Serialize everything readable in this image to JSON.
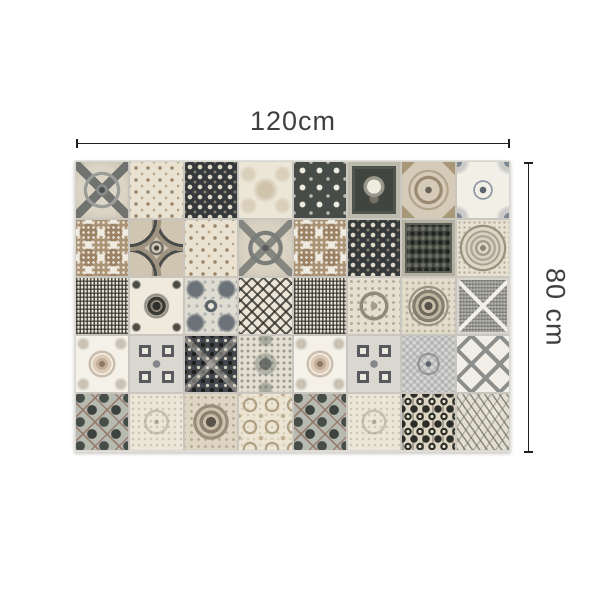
{
  "dimensions": {
    "width_label": "120cm",
    "height_label": "80 cm"
  },
  "mat": {
    "description": "patchwork azulejo-style vinyl tile mat, grayscale and taupe vintage patterns",
    "grid": {
      "rows": 5,
      "cols": 8
    },
    "tiles": [
      "gray-cross-medallion",
      "tan-floral-lattice",
      "dark-damask",
      "faded-damask",
      "charcoal-snowflake",
      "framed-bouquet",
      "taupe-octagon",
      "corner-flourish",
      "taupe-rosette-dots",
      "concave-frame",
      "tan-floral-lattice",
      "gray-circle-cross",
      "taupe-rosette-dots",
      "dark-damask",
      "dark-pictorial",
      "lace-mandala",
      "speckle-maze",
      "black-sunflower",
      "gray-kaleidoscope",
      "argyle-cross",
      "speckle-maze",
      "damask-wreath",
      "target-medallion",
      "diamond-x-speckle",
      "rose-swirl",
      "four-squares",
      "dark-kaleidoscope",
      "speckle-damask",
      "rose-swirl",
      "four-squares",
      "mottled-diamond",
      "gray-trellis",
      "sage-snowflake",
      "faded-medallion",
      "taupe-ring",
      "floral-circles",
      "sage-snowflake",
      "faded-medallion",
      "black-ikat",
      "feather-leaf"
    ]
  },
  "palette": {
    "background": "#ffffff",
    "label_text": "#3f3f3f",
    "dim_line": "#1f1f1f",
    "grout": "#c9c6bf",
    "cream": "#ece6d7",
    "beige": "#d8d1c1",
    "tan": "#a38e74",
    "taupe": "#9b8265",
    "mid_gray": "#7b7d7a",
    "slate": "#6c7378",
    "charcoal": "#43464a",
    "near_black": "#2e2f2b",
    "sage": "#b6bab0"
  }
}
